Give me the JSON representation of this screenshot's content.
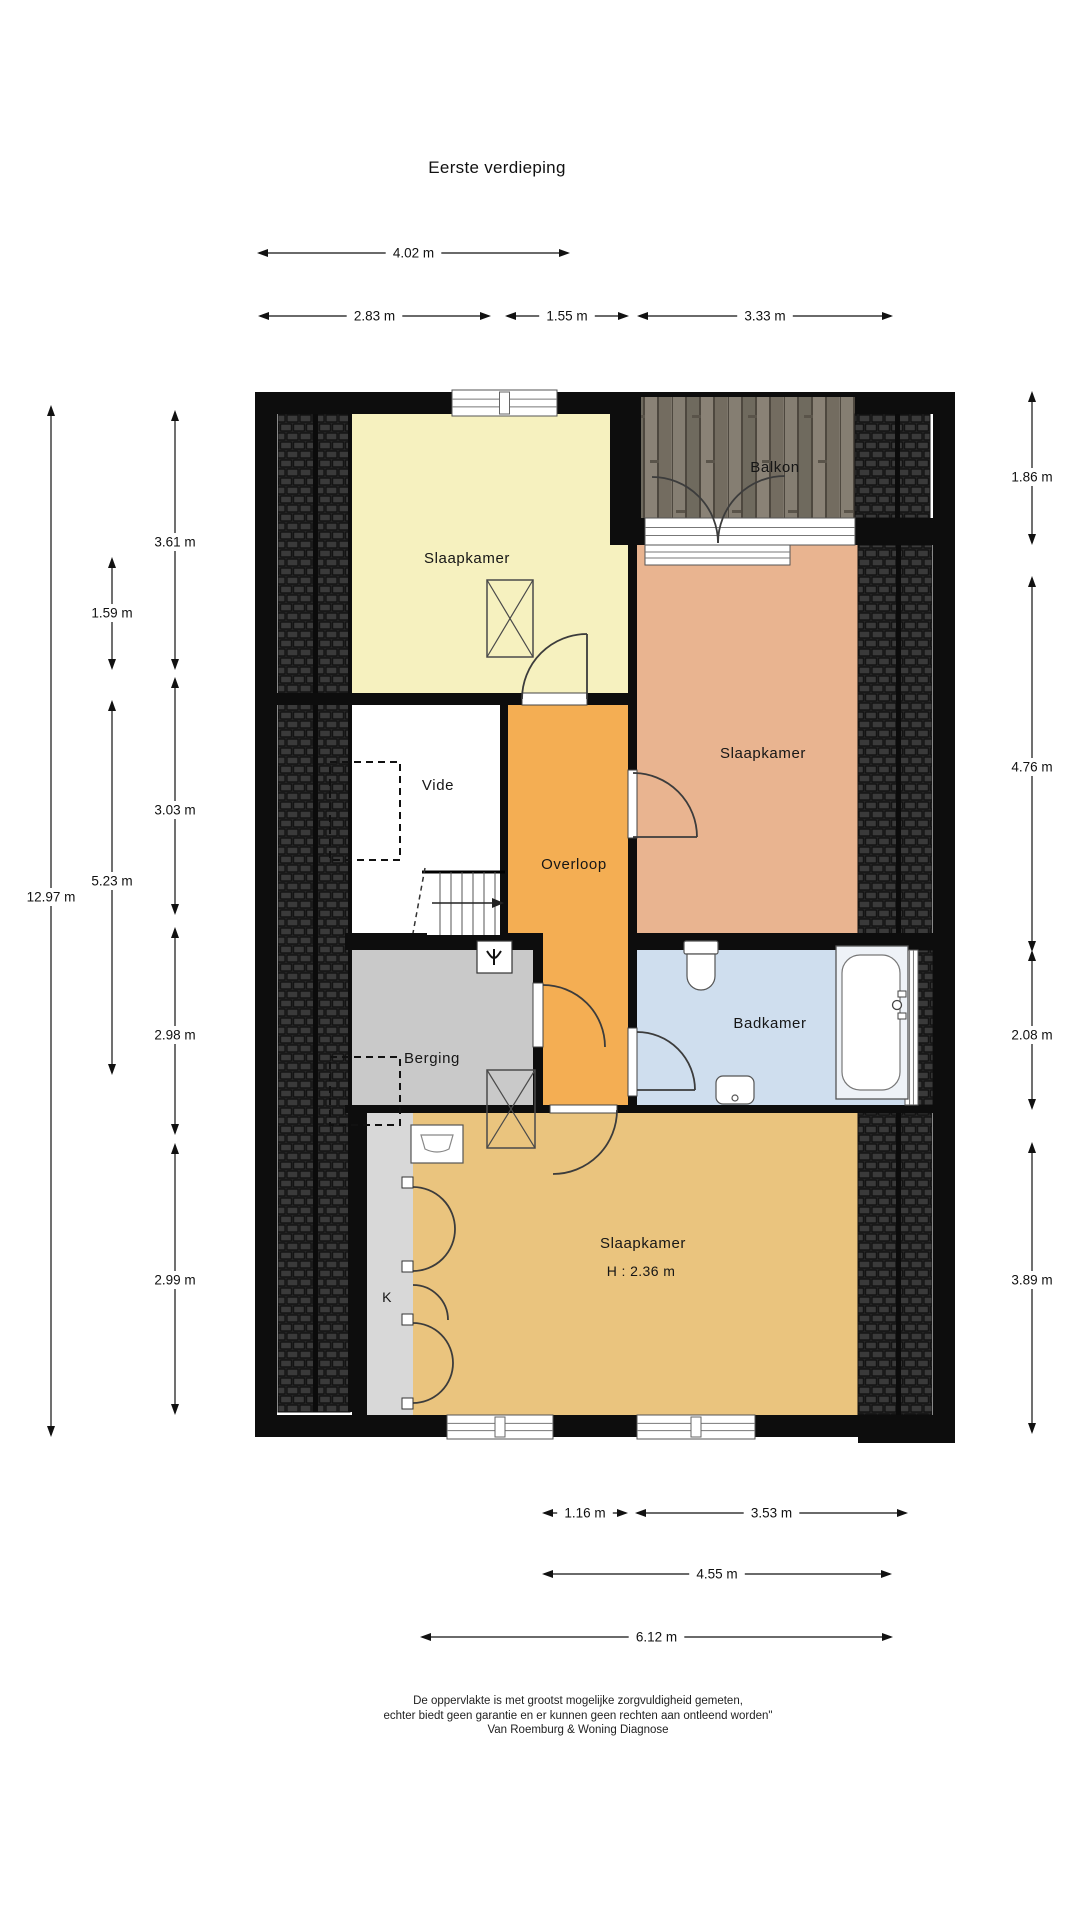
{
  "title": "Eerste verdieping",
  "footer": {
    "line1": "De oppervlakte is met grootst mogelijke zorgvuldigheid gemeten,",
    "line2": "echter biedt geen garantie en er kunnen geen rechten aan ontleend worden\"",
    "line3": "Van Roemburg & Woning Diagnose"
  },
  "colors": {
    "wall": "#0d0d0d",
    "thin_line": "#1e1e1e",
    "room_yellow": "#f6f1bf",
    "room_salmon": "#e9b490",
    "room_orange": "#f4ae53",
    "room_gray": "#c9c9c9",
    "room_blue": "#cfdeee",
    "room_tan": "#eac47e",
    "room_white": "#ffffff",
    "closet_strip": "#d8d8d8",
    "tile_bg": "#262626",
    "tile_brick": "#3a3a3a",
    "tile_seam": "#141414",
    "wood_base": "#7d766b",
    "door_arc": "#3c3c3c",
    "fixture_stroke": "#4a4a4a",
    "dim_color": "#111111"
  },
  "plan": {
    "rooms": [
      {
        "name": "slaapkamer-1",
        "fill": "room_yellow",
        "path": "M352,414 H610 V545 H632 V699 H352 Z"
      },
      {
        "name": "slaapkamer-2",
        "fill": "room_salmon",
        "path": "M637,530 H858 V942 H637 Z"
      },
      {
        "name": "overloop",
        "fill": "room_orange",
        "path": "M505,699 H632 V1109 H540 V945 H505 Z"
      },
      {
        "name": "vide",
        "fill": "room_white",
        "path": "M352,699 H505 V939 H352 Z"
      },
      {
        "name": "berging",
        "fill": "room_gray",
        "path": "M350,945 H535 V1109 H350 Z"
      },
      {
        "name": "badkamer",
        "fill": "room_blue",
        "path": "M632,945 H918 V1109 H632 Z"
      },
      {
        "name": "slaapkamer-3",
        "fill": "room_tan",
        "path": "M413,1109 H858 V1419 H413 Z"
      },
      {
        "name": "kast",
        "fill": "closet_strip",
        "path": "M367,1109 H413 V1419 H367 Z"
      }
    ],
    "balcony": {
      "x": 641,
      "y": 395,
      "w": 214,
      "h": 123
    },
    "roof_hatches": [
      {
        "x": 278,
        "y": 414,
        "w": 72,
        "h": 998,
        "dividers": [
          313
        ]
      },
      {
        "x": 855,
        "y": 414,
        "w": 75,
        "h": 104,
        "dividers": [
          895
        ]
      },
      {
        "x": 858,
        "y": 545,
        "w": 74,
        "h": 393,
        "dividers": [
          896
        ]
      },
      {
        "x": 918,
        "y": 950,
        "w": 15,
        "h": 155,
        "dividers": []
      },
      {
        "x": 858,
        "y": 1113,
        "w": 74,
        "h": 302,
        "dividers": [
          896
        ]
      }
    ],
    "walls": [
      {
        "x": 255,
        "y": 392,
        "w": 386,
        "h": 22
      },
      {
        "x": 855,
        "y": 392,
        "w": 100,
        "h": 22
      },
      {
        "x": 641,
        "y": 392,
        "w": 214,
        "h": 5
      },
      {
        "x": 255,
        "y": 392,
        "w": 22,
        "h": 1045
      },
      {
        "x": 933,
        "y": 392,
        "w": 22,
        "h": 1045
      },
      {
        "x": 255,
        "y": 1415,
        "w": 700,
        "h": 22
      },
      {
        "x": 858,
        "y": 1415,
        "w": 97,
        "h": 28
      },
      {
        "x": 610,
        "y": 392,
        "w": 31,
        "h": 153
      },
      {
        "x": 628,
        "y": 545,
        "w": 9,
        "h": 568
      },
      {
        "x": 610,
        "y": 518,
        "w": 345,
        "h": 27
      },
      {
        "x": 255,
        "y": 693,
        "w": 382,
        "h": 12
      },
      {
        "x": 500,
        "y": 699,
        "w": 8,
        "h": 246
      },
      {
        "x": 345,
        "y": 933,
        "w": 198,
        "h": 17
      },
      {
        "x": 533,
        "y": 945,
        "w": 10,
        "h": 164
      },
      {
        "x": 628,
        "y": 933,
        "w": 305,
        "h": 17
      },
      {
        "x": 345,
        "y": 1105,
        "w": 610,
        "h": 8
      },
      {
        "x": 352,
        "y": 1113,
        "w": 15,
        "h": 302
      },
      {
        "x": 348,
        "y": 414,
        "w": 4,
        "h": 998
      }
    ],
    "windows": [
      {
        "name": "window-top",
        "x": 452,
        "y": 390,
        "w": 105,
        "h": 26,
        "o": "h",
        "tick": true
      },
      {
        "name": "balkon-doorsill",
        "x": 645,
        "y": 518,
        "w": 210,
        "h": 27,
        "o": "h",
        "tick": false
      },
      {
        "name": "window-slaapkamer-2",
        "x": 645,
        "y": 545,
        "w": 145,
        "h": 20,
        "o": "h",
        "tick": false
      },
      {
        "name": "window-badkamer",
        "x": 905,
        "y": 950,
        "w": 13,
        "h": 155,
        "o": "v",
        "tick": false
      },
      {
        "name": "window-bottom-left",
        "x": 447,
        "y": 1415,
        "w": 106,
        "h": 24,
        "o": "h",
        "tick": true
      },
      {
        "name": "window-bottom-right",
        "x": 637,
        "y": 1415,
        "w": 118,
        "h": 24,
        "o": "h",
        "tick": true
      }
    ],
    "door_frames": [
      {
        "x": 522,
        "y": 693,
        "w": 65,
        "h": 12
      },
      {
        "x": 628,
        "y": 770,
        "w": 9,
        "h": 68
      },
      {
        "x": 533,
        "y": 983,
        "w": 10,
        "h": 64
      },
      {
        "x": 628,
        "y": 1028,
        "w": 9,
        "h": 68
      },
      {
        "x": 550,
        "y": 1105,
        "w": 67,
        "h": 8
      }
    ],
    "door_arcs": [
      {
        "d": "M522,699 A65,65 0 0 1 587,634"
      },
      {
        "d": "M718,543 A66,66 0 0 0 652,477"
      },
      {
        "d": "M718,543 A67,67 0 0 1 785,476"
      },
      {
        "d": "M633,773 A64,64 0 0 1 697,837"
      },
      {
        "d": "M543,985 A62,62 0 0 1 605,1047"
      },
      {
        "d": "M637,1032 A58,58 0 0 1 695,1090"
      },
      {
        "d": "M617,1110 A64,64 0 0 1 553,1174"
      },
      {
        "d": "M413,1187 A42,42 0 0 1 455,1229"
      },
      {
        "d": "M413,1271 A42,42 0 0 0 455,1229"
      },
      {
        "d": "M413,1285 A35,35 0 0 1 448,1320"
      },
      {
        "d": "M413,1323 A40,40 0 0 1 453,1363"
      },
      {
        "d": "M413,1403 A40,40 0 0 0 453,1363"
      }
    ],
    "door_leaves": [
      {
        "x1": 587,
        "y1": 699,
        "x2": 587,
        "y2": 634
      },
      {
        "x1": 633,
        "y1": 837,
        "x2": 697,
        "y2": 837
      },
      {
        "x1": 637,
        "y1": 1090,
        "x2": 695,
        "y2": 1090
      }
    ],
    "hinge_blocks": [
      {
        "x": 402,
        "y": 1177
      },
      {
        "x": 402,
        "y": 1261
      },
      {
        "x": 402,
        "y": 1314
      },
      {
        "x": 402,
        "y": 1398
      }
    ],
    "dashed_boxes": [
      {
        "x": 330,
        "y": 762,
        "w": 70,
        "h": 98
      },
      {
        "x": 330,
        "y": 1057,
        "w": 70,
        "h": 68
      }
    ],
    "x_boxes": [
      {
        "x": 487,
        "y": 580,
        "w": 46,
        "h": 77
      },
      {
        "x": 487,
        "y": 1070,
        "w": 48,
        "h": 78
      }
    ],
    "stairs": {
      "x": 427,
      "y": 872,
      "w": 73,
      "h": 63,
      "treads": [
        440,
        451,
        462,
        473,
        484,
        495
      ],
      "arrow_y": 903,
      "arrow_x1": 432,
      "arrow_x2": 492,
      "dash": {
        "x1": 425,
        "y1": 868,
        "x2": 413,
        "y2": 933
      }
    },
    "fixtures": {
      "wtw_box": {
        "x": 477,
        "y": 941,
        "w": 35,
        "h": 32
      },
      "toilet": {
        "tank": {
          "x": 684,
          "y": 941,
          "w": 34,
          "h": 13
        },
        "bowl": "M687,954 h28 v22 a14,14 0 0 1 -28,0 z"
      },
      "sink": {
        "x": 716,
        "y": 1076,
        "w": 38,
        "h": 28
      },
      "bathtub": {
        "outer": {
          "x": 836,
          "y": 946,
          "w": 72,
          "h": 153
        },
        "inner": {
          "x": 842,
          "y": 955,
          "w": 58,
          "h": 135
        },
        "faucet": {
          "cx": 897,
          "cy": 1005,
          "r": 4.5
        }
      },
      "basin_berging": {
        "x": 411,
        "y": 1125,
        "w": 52,
        "h": 38
      }
    },
    "room_labels": [
      {
        "text": "Slaapkamer",
        "x": 467,
        "y": 563,
        "cls": "room-label"
      },
      {
        "text": "Balkon",
        "x": 775,
        "y": 472,
        "cls": "room-label"
      },
      {
        "text": "Slaapkamer",
        "x": 763,
        "y": 758,
        "cls": "room-label"
      },
      {
        "text": "Vide",
        "x": 438,
        "y": 790,
        "cls": "room-label"
      },
      {
        "text": "Overloop",
        "x": 574,
        "y": 869,
        "cls": "room-label"
      },
      {
        "text": "Berging",
        "x": 432,
        "y": 1063,
        "cls": "room-label"
      },
      {
        "text": "Badkamer",
        "x": 770,
        "y": 1028,
        "cls": "room-label"
      },
      {
        "text": "Slaapkamer",
        "x": 643,
        "y": 1248,
        "cls": "room-label"
      },
      {
        "text": "H : 2.36 m",
        "x": 641,
        "y": 1276,
        "cls": "room-label-small"
      },
      {
        "text": "K",
        "x": 387,
        "y": 1302,
        "cls": "room-label-small"
      }
    ]
  },
  "dimensions": {
    "horizontal": [
      {
        "x1": 257,
        "x2": 570,
        "y": 253,
        "label": "4.02 m"
      },
      {
        "x1": 258,
        "x2": 491,
        "y": 316,
        "label": "2.83 m"
      },
      {
        "x1": 505,
        "x2": 629,
        "y": 316,
        "label": "1.55 m"
      },
      {
        "x1": 637,
        "x2": 893,
        "y": 316,
        "label": "3.33 m"
      },
      {
        "x1": 542,
        "x2": 628,
        "y": 1513,
        "label": "1.16 m"
      },
      {
        "x1": 635,
        "x2": 908,
        "y": 1513,
        "label": "3.53 m"
      },
      {
        "x1": 542,
        "x2": 892,
        "y": 1574,
        "label": "4.55 m"
      },
      {
        "x1": 420,
        "x2": 893,
        "y": 1637,
        "label": "6.12 m"
      }
    ],
    "vertical": [
      {
        "y1": 405,
        "y2": 1437,
        "x": 51,
        "label": "12.97 m",
        "ty": 897
      },
      {
        "y1": 557,
        "y2": 670,
        "x": 112,
        "label": "1.59 m",
        "ty": 613
      },
      {
        "y1": 700,
        "y2": 1075,
        "x": 112,
        "label": "5.23 m",
        "ty": 881
      },
      {
        "y1": 410,
        "y2": 670,
        "x": 175,
        "label": "3.61 m",
        "ty": 542
      },
      {
        "y1": 677,
        "y2": 915,
        "x": 175,
        "label": "3.03 m",
        "ty": 810
      },
      {
        "y1": 927,
        "y2": 1135,
        "x": 175,
        "label": "2.98 m",
        "ty": 1035
      },
      {
        "y1": 1143,
        "y2": 1415,
        "x": 175,
        "label": "2.99 m",
        "ty": 1280
      },
      {
        "y1": 391,
        "y2": 545,
        "x": 1032,
        "label": "1.86 m",
        "ty": 477
      },
      {
        "y1": 576,
        "y2": 952,
        "x": 1032,
        "label": "4.76 m",
        "ty": 767
      },
      {
        "y1": 950,
        "y2": 1110,
        "x": 1032,
        "label": "2.08 m",
        "ty": 1035
      },
      {
        "y1": 1142,
        "y2": 1434,
        "x": 1032,
        "label": "3.89 m",
        "ty": 1280
      }
    ]
  }
}
